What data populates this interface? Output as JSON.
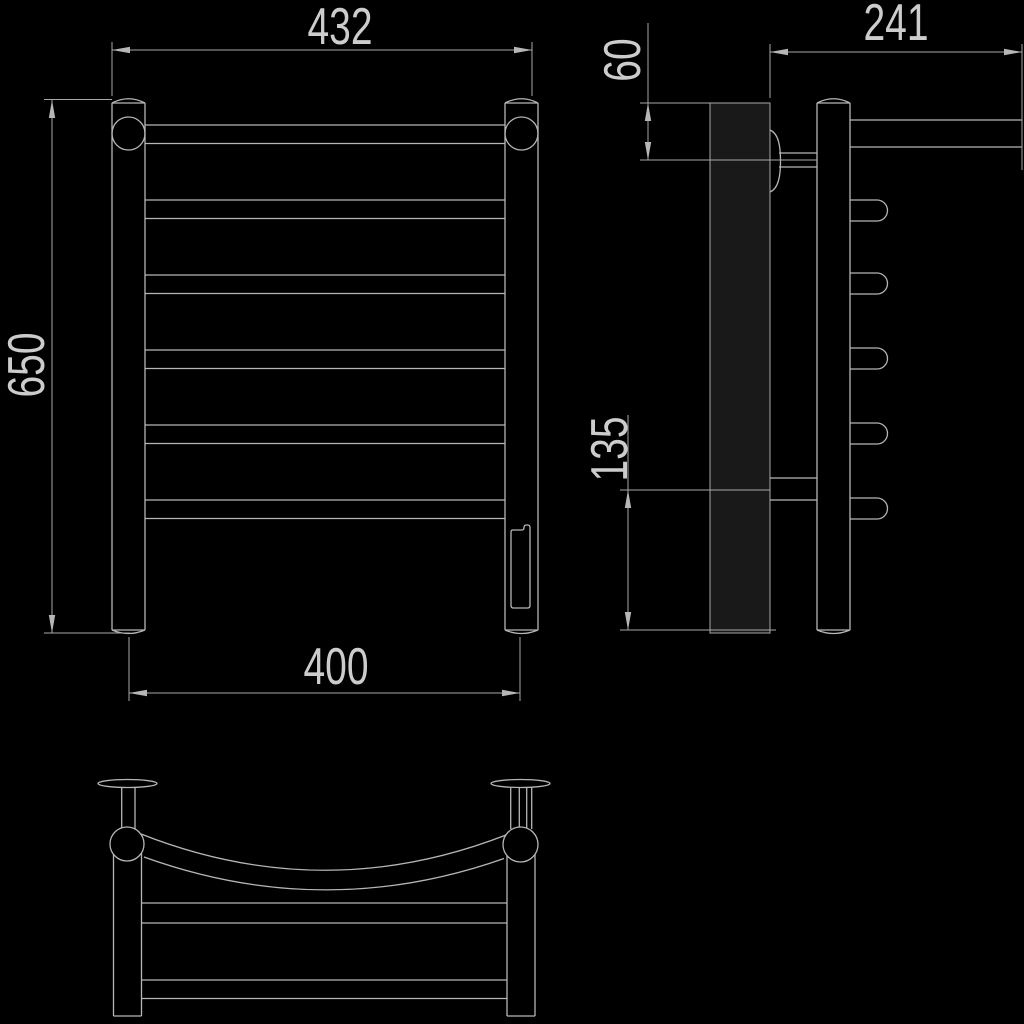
{
  "drawing": {
    "description": "technical-dimension-drawing-of-heated-towel-rail",
    "views": [
      "front",
      "side",
      "bottom"
    ]
  },
  "dimensions": {
    "front": {
      "overall_width": "432",
      "overall_height": "650",
      "post_center_width": "400"
    },
    "side": {
      "depth": "241",
      "top_bracket_offset": "60",
      "bottom_bracket_offset": "135"
    }
  },
  "colors": {
    "background": "#000000",
    "line": "#b6b6b6",
    "dimension_line": "#a8a8a8",
    "text": "#cccccc",
    "wall_plate_fill": "#191919"
  }
}
